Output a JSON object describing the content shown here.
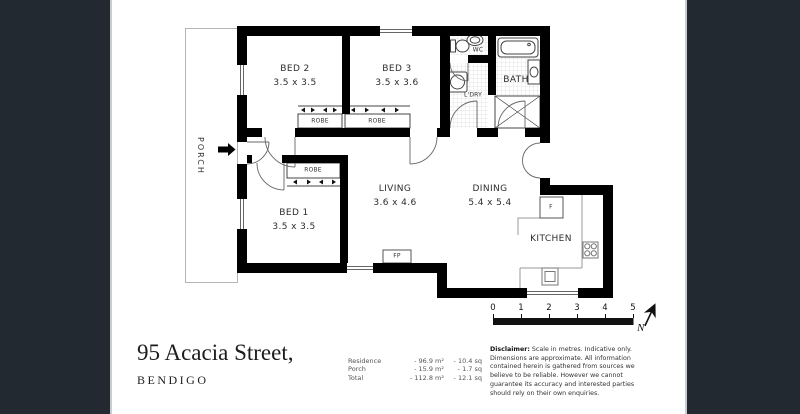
{
  "address": {
    "street": "95 Acacia Street,",
    "suburb": "BENDIGO"
  },
  "rooms": {
    "bed1": {
      "name": "BED 1",
      "dims": "3.5 x 3.5"
    },
    "bed2": {
      "name": "BED 2",
      "dims": "3.5 x 3.5"
    },
    "bed3": {
      "name": "BED 3",
      "dims": "3.5 x 3.6"
    },
    "living": {
      "name": "LIVING",
      "dims": "3.6 x 4.6"
    },
    "dining": {
      "name": "DINING",
      "dims": "5.4 x 5.4"
    },
    "kitchen": {
      "name": "KITCHEN"
    },
    "bath": {
      "name": "BATH"
    },
    "wc": {
      "name": "WC"
    },
    "laundry": {
      "name": "L'DRY"
    },
    "porch": {
      "name": "PORCH"
    }
  },
  "fixtures": {
    "robe": "ROBE",
    "fireplace": "FP",
    "fridge": "F"
  },
  "areas": {
    "rows": [
      {
        "label": "Residence",
        "metric": "-  96.9 m²",
        "imperial": "- 10.4 sq"
      },
      {
        "label": "Porch",
        "metric": "-  15.9 m²",
        "imperial": "-  1.7 sq"
      },
      {
        "label": "Total",
        "metric": "- 112.8 m²",
        "imperial": "- 12.1 sq"
      }
    ]
  },
  "scale_bar": {
    "ticks": [
      "0",
      "1",
      "2",
      "3",
      "4",
      "5"
    ]
  },
  "compass": {
    "north_label": "N"
  },
  "disclaimer": {
    "label": "Disclaimer:",
    "text": " Scale in metres. Indicative only. Dimensions are approximate. All information contained herein is gathered from sources we believe to be reliable. However we cannot guarantee its accuracy and interested parties should rely on their own enquiries."
  },
  "theme": {
    "panel_color": "#232931",
    "wall_color": "#000000",
    "paper_color": "#ffffff"
  }
}
